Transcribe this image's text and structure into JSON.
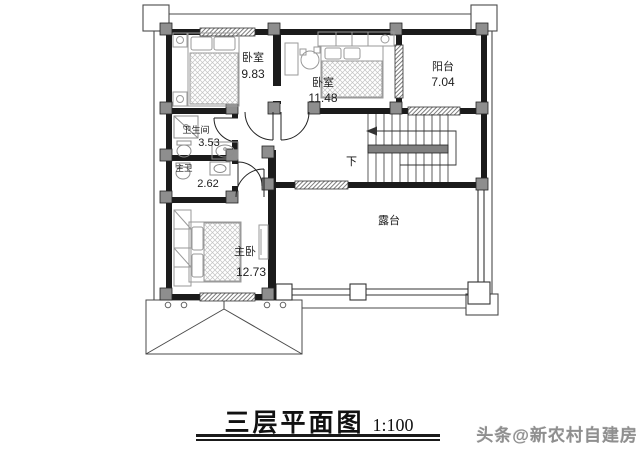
{
  "plan": {
    "title": "三层平面图",
    "scale_label": "1:100",
    "watermark": "头条@新农村自建房",
    "stair_label": "下",
    "rooms": [
      {
        "id": "bedroom-1",
        "name": "卧室",
        "area": "9.83"
      },
      {
        "id": "bedroom-2",
        "name": "卧室",
        "area": "11.48"
      },
      {
        "id": "balcony",
        "name": "阳台",
        "area": "7.04"
      },
      {
        "id": "bathroom",
        "name": "卫生间",
        "area": "3.53"
      },
      {
        "id": "master-bath",
        "name": "主卫",
        "area": "2.62"
      },
      {
        "id": "master-bedroom",
        "name": "主卧",
        "area": "12.73"
      },
      {
        "id": "terrace",
        "name": "露台",
        "area": ""
      }
    ]
  },
  "colors": {
    "wall": "#1b1b1b",
    "pillar": "#8e8e8e",
    "eave_line": "#4a4a4a",
    "furniture": "#9a9a9a",
    "watermark": "#8f8f8f",
    "text": "#1e1e1e"
  }
}
